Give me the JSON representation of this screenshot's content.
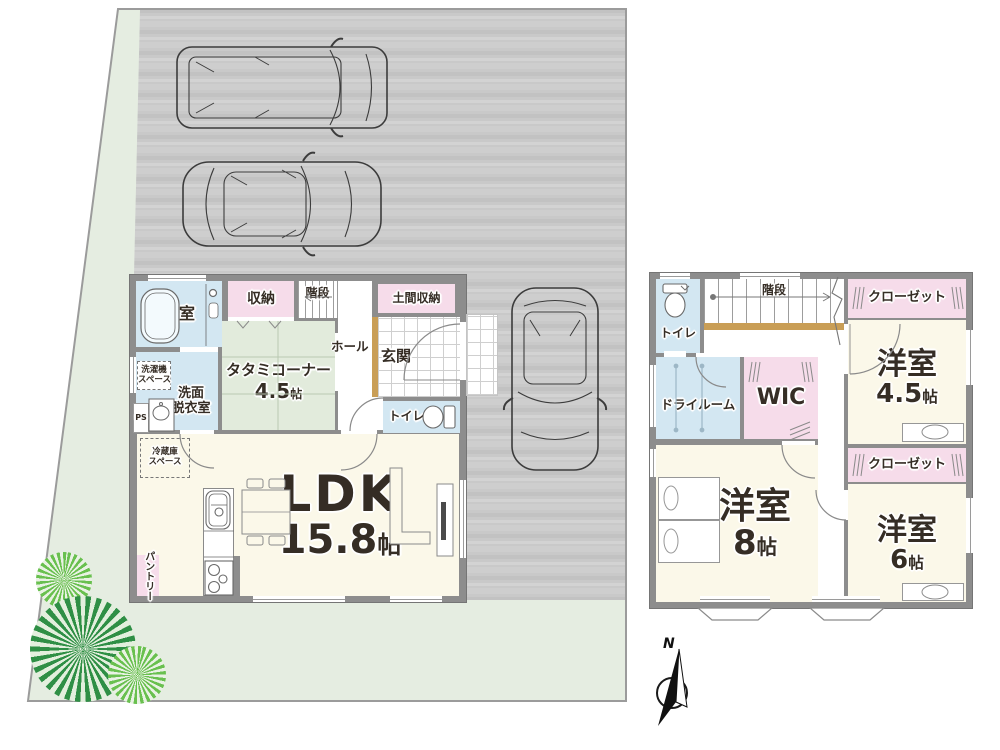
{
  "palette": {
    "wet_area": "#d3e7f2",
    "storage_pink": "#f6dcea",
    "tatami_green": "#e2ebdc",
    "floor_cream": "#fbf8e9",
    "wall_gray": "#8d8d8d",
    "lawn_green": "#e5ede1",
    "pavement_gray": "#c9c9c9",
    "wood_step": "#c99e56"
  },
  "site": {
    "compass_north": "N"
  },
  "floor1": {
    "bath": "浴室",
    "storage": "収納",
    "stairs": "階段",
    "doma_storage": "土間収納",
    "hall": "ホール",
    "genkan": "玄関",
    "tatami": {
      "name": "タタミコーナー",
      "size": "4.5",
      "unit": "帖"
    },
    "washer": {
      "line1": "洗濯機",
      "line2": "スペース"
    },
    "washroom": {
      "line1": "洗面",
      "line2": "脱衣室"
    },
    "ps": "PS",
    "toilet": "トイレ",
    "fridge": {
      "line1": "冷蔵庫",
      "line2": "スペース"
    },
    "pantry": "パントリー",
    "ldk": {
      "name": "LDK",
      "size": "15.8",
      "unit": "帖"
    }
  },
  "floor2": {
    "toilet": "トイレ",
    "stairs": "階段",
    "hall": "ホール",
    "closet_a": "クローゼット",
    "room45": {
      "name": "洋室",
      "size": "4.5",
      "unit": "帖"
    },
    "dryroom": "ドライルーム",
    "wic": "WIC",
    "room8": {
      "name": "洋室",
      "size": "8",
      "unit": "帖"
    },
    "closet_b": "クローゼット",
    "room6": {
      "name": "洋室",
      "size": "6",
      "unit": "帖"
    }
  }
}
